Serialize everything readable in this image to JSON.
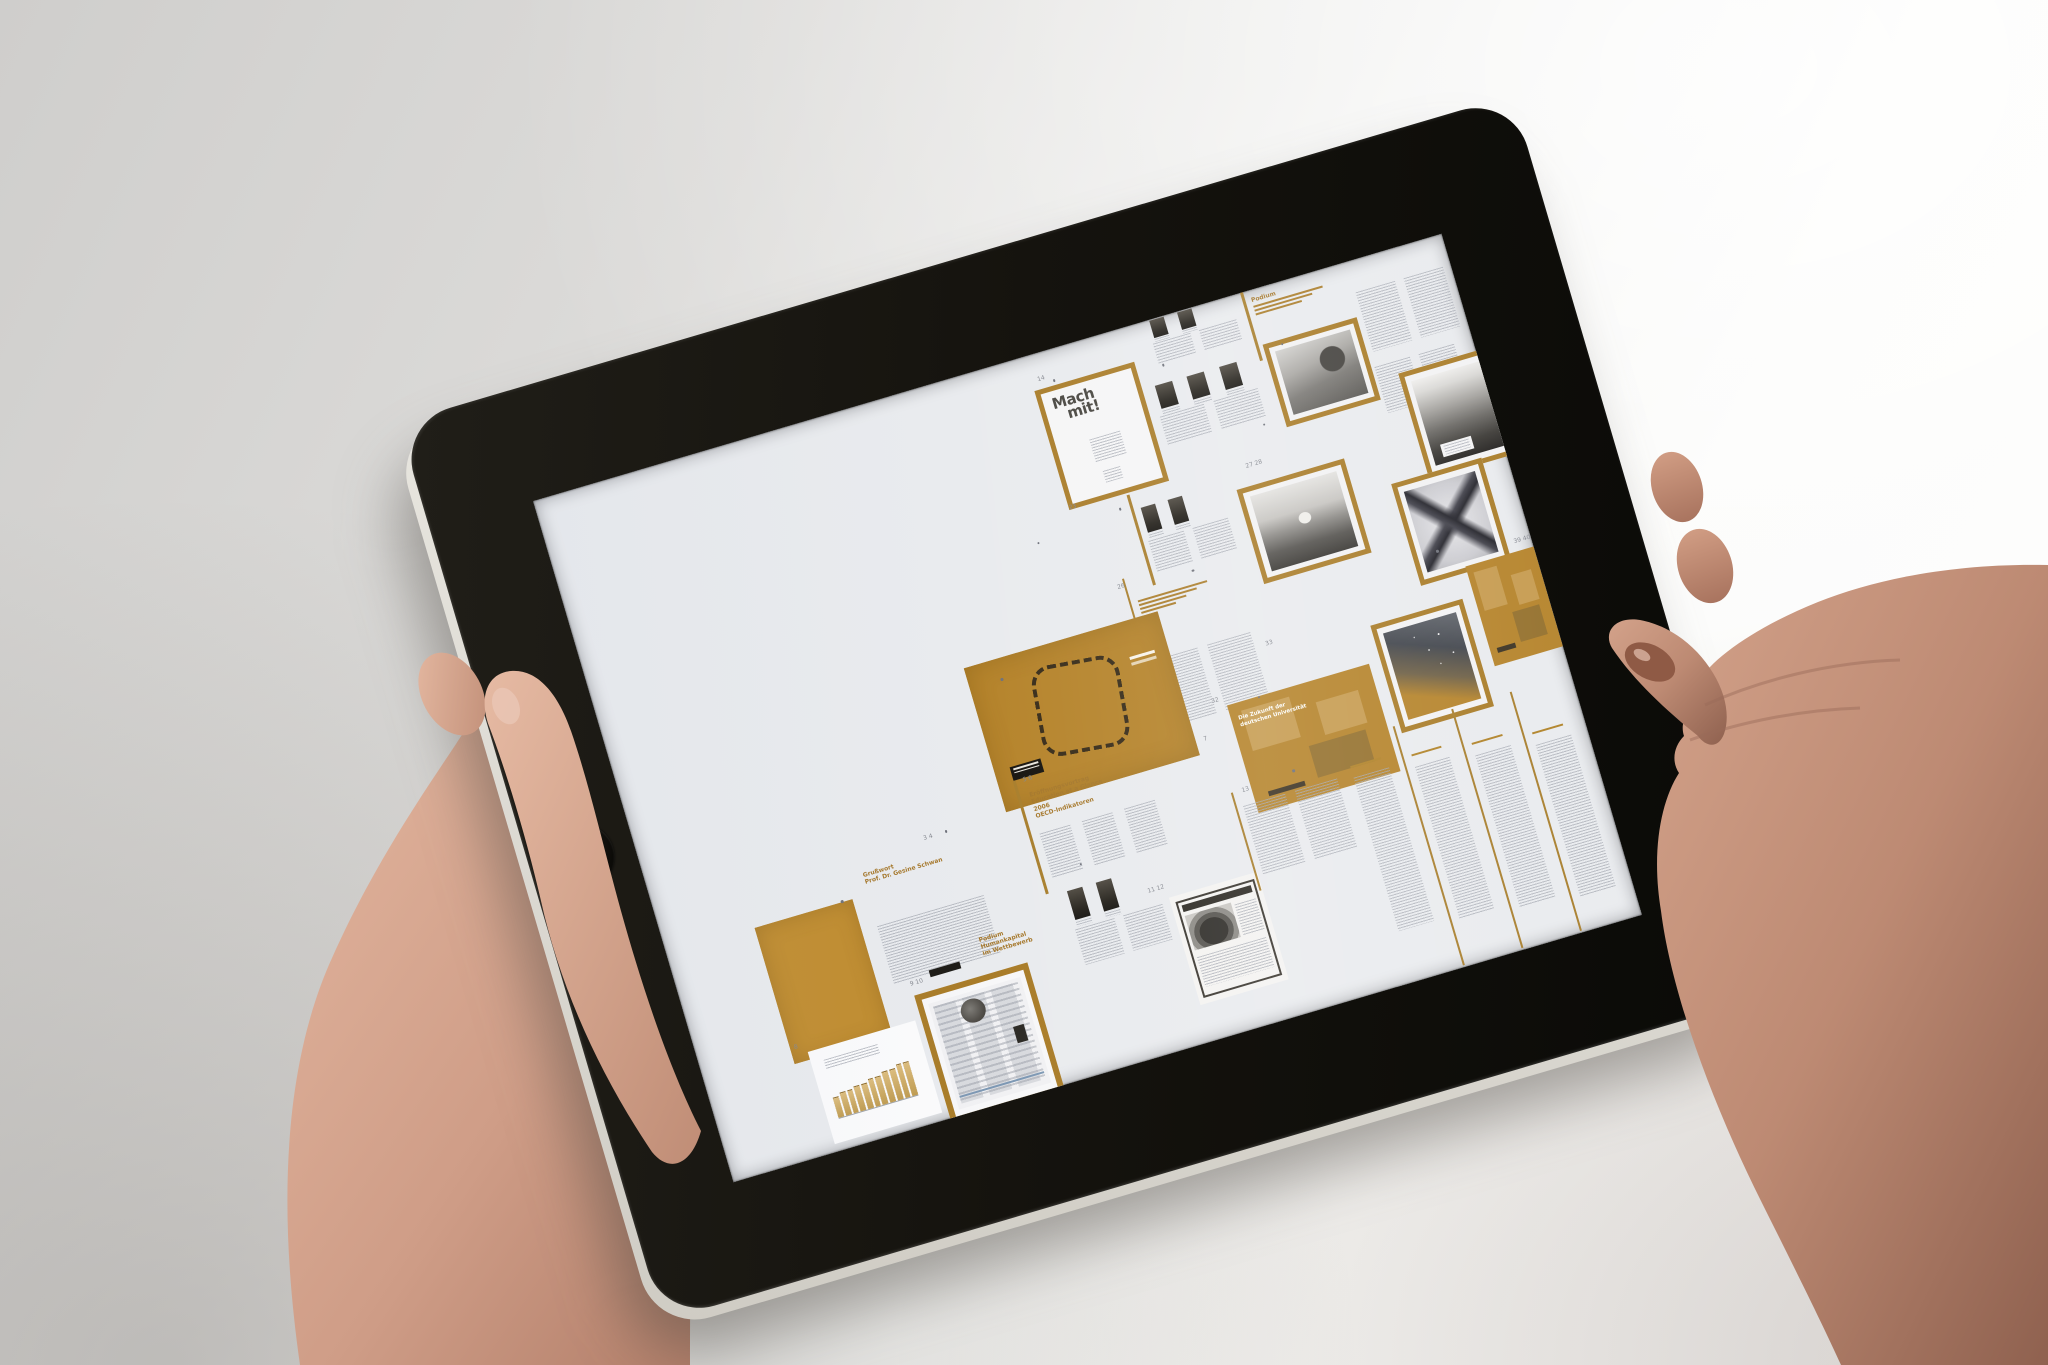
{
  "scene": {
    "colors": {
      "background_left": "#cfcecc",
      "background_right": "#fdfdfc",
      "bezel_black": "#15130e",
      "aluminum_edge": "#e6e3db",
      "screen_white": "#e9ebee",
      "accent_orange": "#ab7d28",
      "orange_page": "#c08c2e",
      "orange_spread": "#b5832a",
      "title_dark": "#46443e",
      "body_text_gray": "#a4a8b1",
      "skin_light": "#e0b29c",
      "skin_dark": "#8f614f",
      "nail_polish": "#8f5a45"
    }
  },
  "tablet": {
    "home_button_icon": "rounded-square"
  },
  "document": {
    "spreads": [
      {
        "name": "spread-top-thumbs",
        "type": "spread-thumbs",
        "x": 636,
        "y": -4,
        "w": 96,
        "h": 54,
        "thumbs": 2,
        "cols": 2
      },
      {
        "name": "spread-top-podium",
        "type": "spread-heading",
        "x": 742,
        "y": 4,
        "w": 92,
        "h": 62,
        "lines": [
          "Podium"
        ],
        "sub": 3,
        "cols": 0,
        "spine": true
      },
      {
        "name": "spread-top-right",
        "type": "spread-text",
        "x": 845,
        "y": 26,
        "w": 100,
        "h": 74,
        "cols": 2
      },
      {
        "name": "page-mach-mit",
        "type": "page-machmit",
        "x": 512,
        "y": 36,
        "w": 94,
        "h": 114,
        "lines": [
          "Mach",
          "mit!"
        ]
      },
      {
        "name": "spread-portraits",
        "type": "spread-thumbs",
        "x": 622,
        "y": 58,
        "w": 112,
        "h": 74,
        "thumbs": 3,
        "cols": 2
      },
      {
        "name": "page-photo-interview",
        "type": "page-photo",
        "x": 744,
        "y": 56,
        "w": 88,
        "h": 76,
        "photo": "desk"
      },
      {
        "name": "spread-row2-text",
        "type": "spread-text",
        "x": 842,
        "y": 104,
        "w": 92,
        "h": 58,
        "cols": 2
      },
      {
        "name": "page-cover-mountain",
        "type": "page-photo",
        "x": 866,
        "y": 122,
        "w": 82,
        "h": 100,
        "photo": "mountain",
        "cap": true
      },
      {
        "name": "spread-row3-thumbs",
        "type": "spread-thumbs",
        "x": 576,
        "y": 170,
        "w": 92,
        "h": 80,
        "thumbs": 2,
        "cols": 2,
        "spine": true
      },
      {
        "name": "page-photo-landscape",
        "type": "page-photo",
        "x": 678,
        "y": 188,
        "w": 102,
        "h": 88,
        "photo": "field"
      },
      {
        "name": "page-xray",
        "type": "page-photo",
        "x": 828,
        "y": 226,
        "w": 84,
        "h": 96,
        "photo": "xray"
      },
      {
        "name": "spread-wachstum",
        "type": "spread-heading",
        "x": 548,
        "y": 256,
        "w": 110,
        "h": 150,
        "lines": [],
        "sub": 4,
        "cols": 2,
        "spine": true
      },
      {
        "name": "spread-tables-photo",
        "type": "spread-orange-photo",
        "x": 366,
        "y": 282,
        "w": 202,
        "h": 150
      },
      {
        "name": "page-stars",
        "type": "page-photo",
        "x": 768,
        "y": 356,
        "w": 86,
        "h": 102,
        "photo": "stars"
      },
      {
        "name": "spread-orange-edge",
        "type": "spread-orange-grid",
        "x": 876,
        "y": 326,
        "w": 71,
        "h": 104,
        "lines": []
      },
      {
        "name": "spread-zukunft",
        "type": "spread-orange-grid",
        "x": 608,
        "y": 392,
        "w": 148,
        "h": 112,
        "lines": [
          "Die Zukunft der",
          "deutschen Universität"
        ]
      },
      {
        "name": "spread-eroeffnung",
        "type": "spread-heading",
        "x": 388,
        "y": 414,
        "w": 132,
        "h": 100,
        "lines": [
          "Eröffnungsvortrag",
          "Education at a Glance",
          "2006",
          "OECD-Indikatoren"
        ],
        "cols": 3,
        "spine": true
      },
      {
        "name": "page-orange-solid",
        "type": "page-orange",
        "x": 92,
        "y": 472,
        "w": 102,
        "h": 142
      },
      {
        "name": "spread-grusswort",
        "type": "spread-heading",
        "x": 206,
        "y": 442,
        "w": 122,
        "h": 132,
        "lines": [
          "Grußwort",
          "Prof. Dr. Gesine Schwan"
        ],
        "cols": 1,
        "dark_note": true
      },
      {
        "name": "page-bar-chart",
        "type": "page-chart",
        "x": 108,
        "y": 606,
        "w": 112,
        "h": 96,
        "bars": [
          7,
          8,
          8,
          9,
          9,
          10,
          10,
          11,
          11,
          12,
          12
        ]
      },
      {
        "name": "page-website",
        "type": "page-web",
        "x": 226,
        "y": 582,
        "w": 106,
        "h": 122
      },
      {
        "name": "spread-podium-humankapital",
        "type": "spread-heading",
        "x": 300,
        "y": 540,
        "w": 92,
        "h": 72,
        "lines": [
          "Podium",
          "Humankapital",
          "im Wettbewerb"
        ],
        "cols": 0
      },
      {
        "name": "spread-row5-thumbs",
        "type": "spread-thumbs",
        "x": 396,
        "y": 516,
        "w": 100,
        "h": 92,
        "thumbs": 2,
        "cols": 2
      },
      {
        "name": "page-ad-car",
        "type": "page-ad",
        "x": 498,
        "y": 560,
        "w": 92,
        "h": 112
      },
      {
        "name": "spread-row5-text",
        "type": "spread-text",
        "x": 592,
        "y": 486,
        "w": 108,
        "h": 86,
        "cols": 2,
        "spine": true
      },
      {
        "name": "spread-program-lists",
        "type": "spread-lists",
        "x": 702,
        "y": 476,
        "w": 245,
        "h": 215,
        "cols": 4
      }
    ],
    "page_numbers": [
      {
        "t": "14",
        "x": 522,
        "y": 26
      },
      {
        "t": "23",
        "x": 516,
        "y": 158
      },
      {
        "t": "27 28",
        "x": 702,
        "y": 168
      },
      {
        "t": "26",
        "x": 540,
        "y": 248
      },
      {
        "t": "33",
        "x": 666,
        "y": 344
      },
      {
        "t": "32",
        "x": 598,
        "y": 384
      },
      {
        "t": "7",
        "x": 578,
        "y": 418
      },
      {
        "t": "39 40",
        "x": 938,
        "y": 316
      },
      {
        "t": "3 4",
        "x": 284,
        "y": 434
      },
      {
        "t": "5 6",
        "x": 396,
        "y": 406
      },
      {
        "t": "8",
        "x": 98,
        "y": 598
      },
      {
        "t": "9 10",
        "x": 232,
        "y": 570
      },
      {
        "t": "11 12",
        "x": 488,
        "y": 548
      },
      {
        "t": "13",
        "x": 602,
        "y": 478
      }
    ],
    "dots": [
      {
        "x": 533,
        "y": 30
      },
      {
        "x": 642,
        "y": 46
      },
      {
        "x": 762,
        "y": 60
      },
      {
        "x": 472,
        "y": 182
      },
      {
        "x": 612,
        "y": 252
      },
      {
        "x": 398,
        "y": 302
      },
      {
        "x": 302,
        "y": 432
      },
      {
        "x": 182,
        "y": 470
      },
      {
        "x": 422,
        "y": 502
      },
      {
        "x": 652,
        "y": 472
      },
      {
        "x": 852,
        "y": 302
      },
      {
        "x": 722,
        "y": 132
      },
      {
        "x": 560,
        "y": 172
      },
      {
        "x": 640,
        "y": 392
      }
    ]
  }
}
